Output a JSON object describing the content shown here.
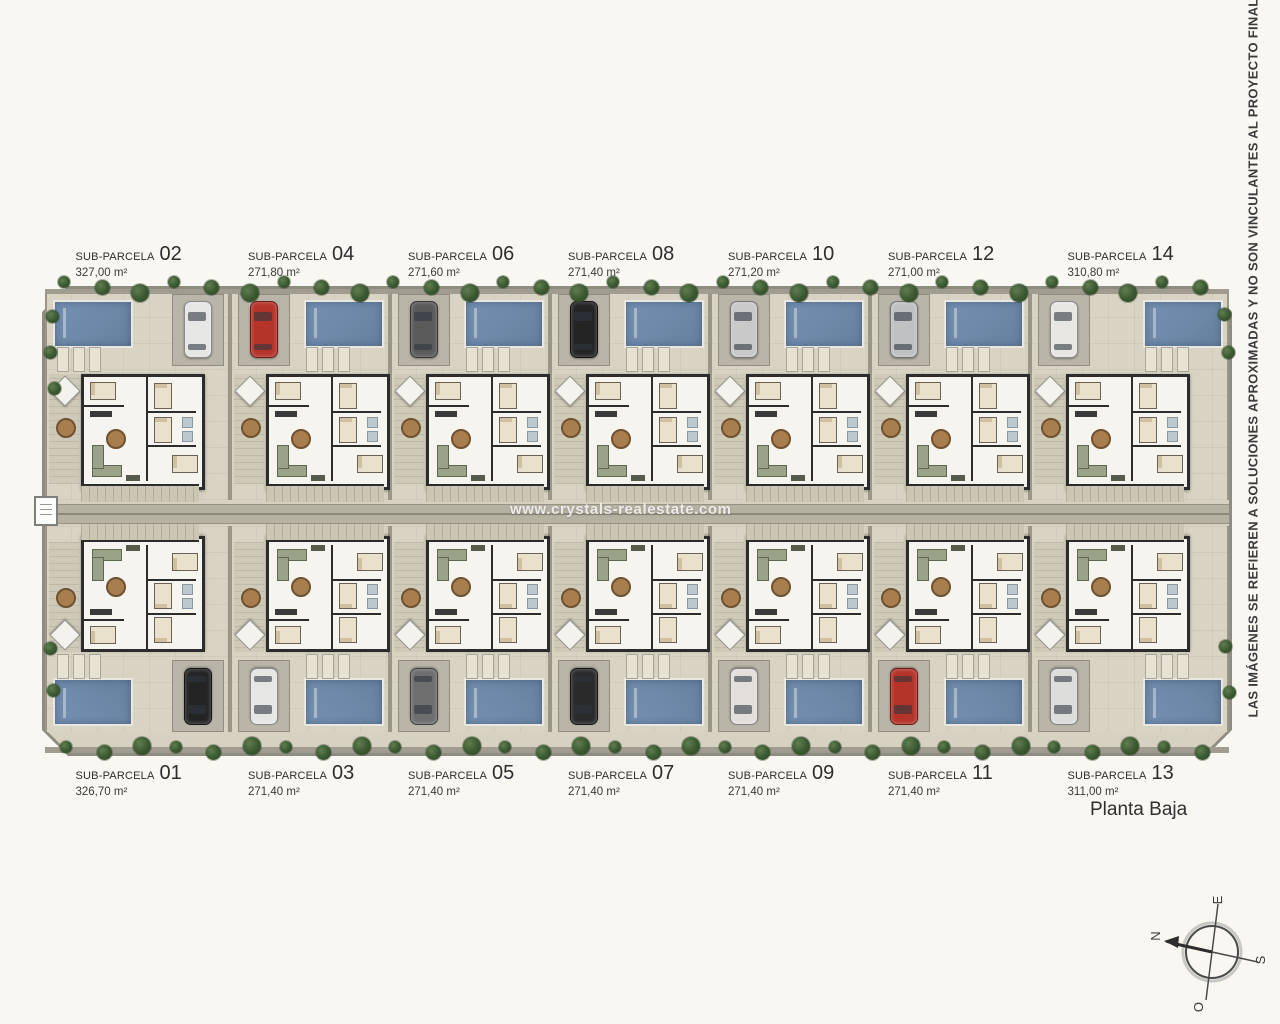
{
  "plan": {
    "floor_label": "Planta Baja",
    "watermark": "www.crystals-realestate.com",
    "disclaimer": "LAS IMÁGENES SE REFIEREN A SOLUCIONES APROXIMADAS Y NO SON VINCULANTES AL PROYECTO FINAL",
    "compass": {
      "n": "N",
      "e": "E",
      "s": "S",
      "o": "O"
    }
  },
  "parcels": {
    "label_prefix": "SUB-PARCELA",
    "top_row": [
      {
        "number": "02",
        "area": "327,00 m²",
        "pool": "left",
        "car_color": "#e6e6e4"
      },
      {
        "number": "04",
        "area": "271,80 m²",
        "pool": "right",
        "car_color": "#b5342a"
      },
      {
        "number": "06",
        "area": "271,60 m²",
        "pool": "right",
        "car_color": "#5a5a5a"
      },
      {
        "number": "08",
        "area": "271,40 m²",
        "pool": "right",
        "car_color": "#242424"
      },
      {
        "number": "10",
        "area": "271,20 m²",
        "pool": "right",
        "car_color": "#c9c9c9"
      },
      {
        "number": "12",
        "area": "271,00 m²",
        "pool": "right",
        "car_color": "#bfc1c3"
      },
      {
        "number": "14",
        "area": "310,80 m²",
        "pool": "right",
        "car_color": "#e8e6e2"
      }
    ],
    "bottom_row": [
      {
        "number": "01",
        "area": "326,70 m²",
        "pool": "left",
        "car_color": "#242424"
      },
      {
        "number": "03",
        "area": "271,40 m²",
        "pool": "right",
        "car_color": "#e6e6e4"
      },
      {
        "number": "05",
        "area": "271,40 m²",
        "pool": "right",
        "car_color": "#6e6e6e"
      },
      {
        "number": "07",
        "area": "271,40 m²",
        "pool": "right",
        "car_color": "#2a2a2a"
      },
      {
        "number": "09",
        "area": "271,40 m²",
        "pool": "right",
        "car_color": "#e3e0dc"
      },
      {
        "number": "11",
        "area": "271,40 m²",
        "pool": "right",
        "car_color": "#b5342a"
      },
      {
        "number": "13",
        "area": "311,00 m²",
        "pool": "right",
        "car_color": "#dcdcda"
      }
    ]
  },
  "colors": {
    "ground": "#d8d3c2",
    "pool": "#6e8aad",
    "path": "#b6b2a2",
    "tree": "#3d5a35",
    "house_wall": "#2c2c2c",
    "accent_red_car": "#b5342a"
  }
}
